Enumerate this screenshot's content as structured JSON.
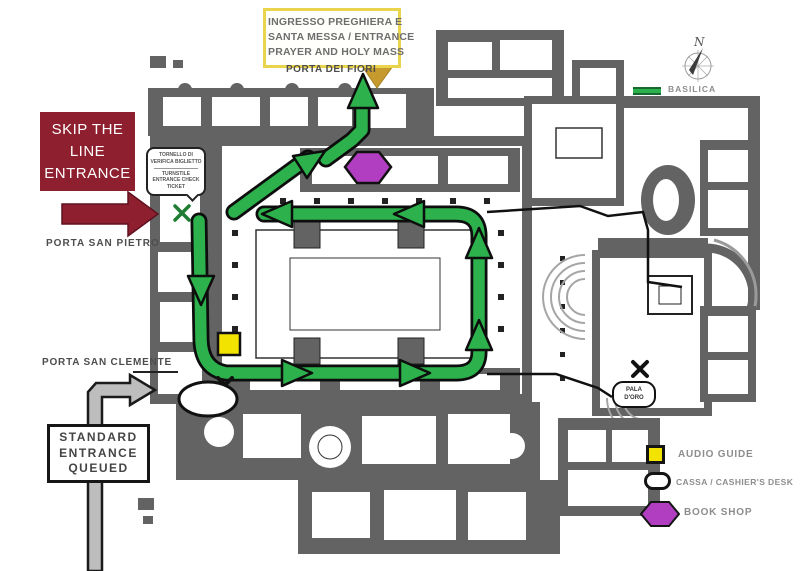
{
  "colors": {
    "route_green": "#2cb14c",
    "maroon": "#8e1f2e",
    "audio_yellow": "#f3e300",
    "book_purple": "#b13ec1",
    "mass_arrow_olive": "#c79a2e",
    "queue_gray": "#bdbdbd",
    "wall_gray": "#636363",
    "info_border_yellow": "#e9d44c"
  },
  "info_box": {
    "lines": [
      "INGRESSO PREGHIERA E",
      "SANTA MESSA / ENTRANCE",
      "PRAYER AND HOLY MASS"
    ]
  },
  "entrances": {
    "porta_dei_fiori": "PORTA DEI FIORI",
    "porta_san_pietro": "PORTA SAN PIETRO",
    "porta_san_clemente": "PORTA SAN CLEMENTE"
  },
  "skip_the_line": {
    "lines": [
      "SKIP THE",
      "LINE",
      "ENTRANCE"
    ]
  },
  "standard_entrance": {
    "lines": [
      "STANDARD",
      "ENTRANCE",
      "QUEUED"
    ]
  },
  "turnstile_callout": {
    "lines_it": [
      "TORNELLO DI",
      "VERIFICA BIGLIETTO"
    ],
    "lines_en": [
      "TURNSTILE",
      "ENTRANCE CHECK",
      "TICKET"
    ]
  },
  "map_labels": {
    "pala_doro": [
      "PALA",
      "D'ORO"
    ],
    "compass_north": "N"
  },
  "legend": {
    "basilica_label": "BASILICA",
    "items": [
      {
        "key": "audio_guide",
        "label": "AUDIO GUIDE"
      },
      {
        "key": "cassa",
        "label": "CASSA / CASHIER'S DESK"
      },
      {
        "key": "book_shop",
        "label": "BOOK SHOP"
      }
    ]
  }
}
